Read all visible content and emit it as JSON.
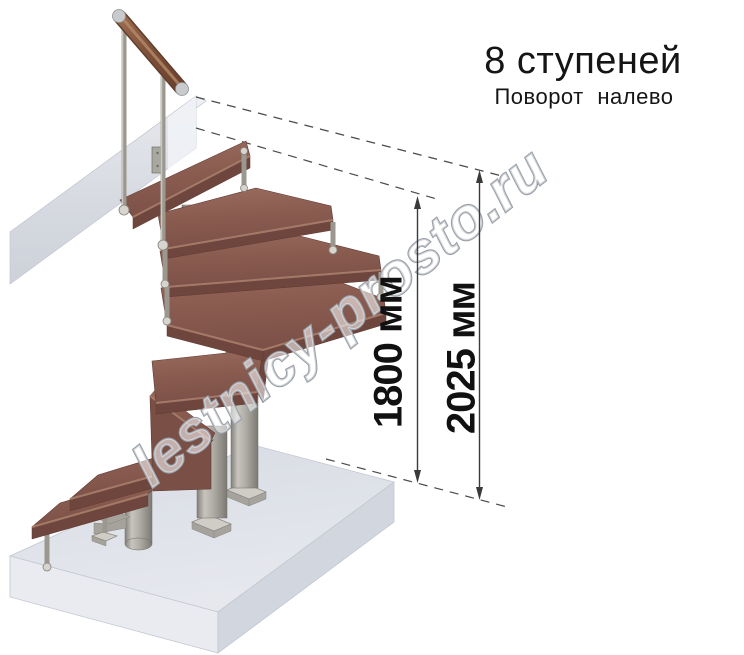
{
  "title": {
    "steps_count": "8 ступеней",
    "turn_direction": "Поворот налево"
  },
  "dimensions": {
    "height_to_top_step": "1800 мм",
    "total_height": "2025 мм"
  },
  "watermark": {
    "text": "lestnicy-prosto.ru"
  },
  "scene": {
    "subject": "modular staircase, 8 steps, left turn, axonometric view",
    "parts": [
      "floor-slab",
      "landing-beam",
      "wooden-handrail",
      "balusters",
      "winder-treads",
      "support-columns",
      "base-plates"
    ]
  },
  "colors": {
    "wood": "#8e6054",
    "wood-dark": "#6e463d",
    "wood-light": "#ad8270",
    "metal": "#9a988f",
    "metal-light": "#c9c7bf",
    "slab-top": "#dfe2e9",
    "beam": "#d9dce3",
    "dim": "#3a3a3a",
    "title": "#151515",
    "wm-stroke": "#9aa0a8"
  }
}
